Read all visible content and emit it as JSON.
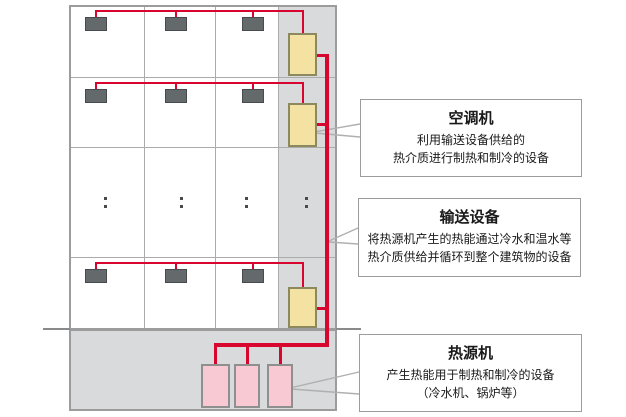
{
  "diagram_title": "",
  "callouts": [
    {
      "title": "空调机",
      "lines": [
        "利用输送设备供给的",
        "热介质进行制热和制冷的设备"
      ]
    },
    {
      "title": "输送设备",
      "lines": [
        "将热源机产生的热能通过冷水和温水等",
        "热介质供给并循环到整个建筑物的设备"
      ]
    },
    {
      "title": "热源机",
      "lines": [
        "产生热能用于制热和制冷的设备",
        "（冷水机、锅炉等）"
      ]
    }
  ],
  "colors": {
    "pipe-red": "#d8062f",
    "ahu-yellow": "#f3e2a1",
    "ahu-border": "#8d895f",
    "heat-pink": "#f9c9d3",
    "unit-dark": "#64696b",
    "shaft-gray": "#d8dadb",
    "grid-gray": "#ababab",
    "building-border": "#9c9c9c",
    "ground-gray": "#8a8a8a",
    "pointer-gray": "#b0b0b0"
  }
}
